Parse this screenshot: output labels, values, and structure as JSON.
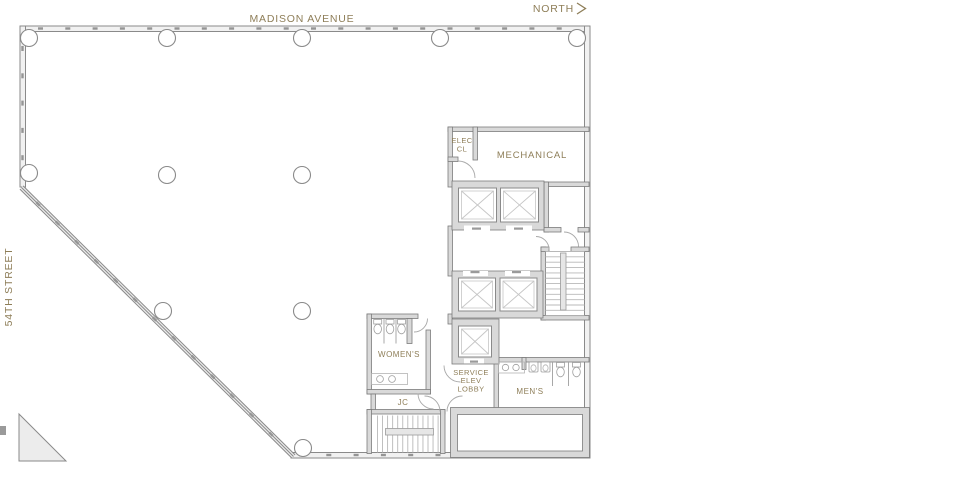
{
  "streets": {
    "top": "MADISON AVENUE",
    "left": "54TH STREET"
  },
  "compass": {
    "north": "NORTH"
  },
  "rooms": {
    "elec_line1": "ELEC",
    "elec_line2": "CL",
    "mechanical": "MECHANICAL",
    "womens": "WOMEN'S",
    "service_line1": "SERVICE",
    "service_line2": "ELEV",
    "service_line3": "LOBBY",
    "mens": "MEN'S",
    "jc": "JC"
  },
  "colors": {
    "label_text": "#8e7e58",
    "wall_outline": "#8a8a8a",
    "wall_fill": "#d9d9d9",
    "exterior_fill": "#f1f1f1",
    "background": "#ffffff"
  }
}
